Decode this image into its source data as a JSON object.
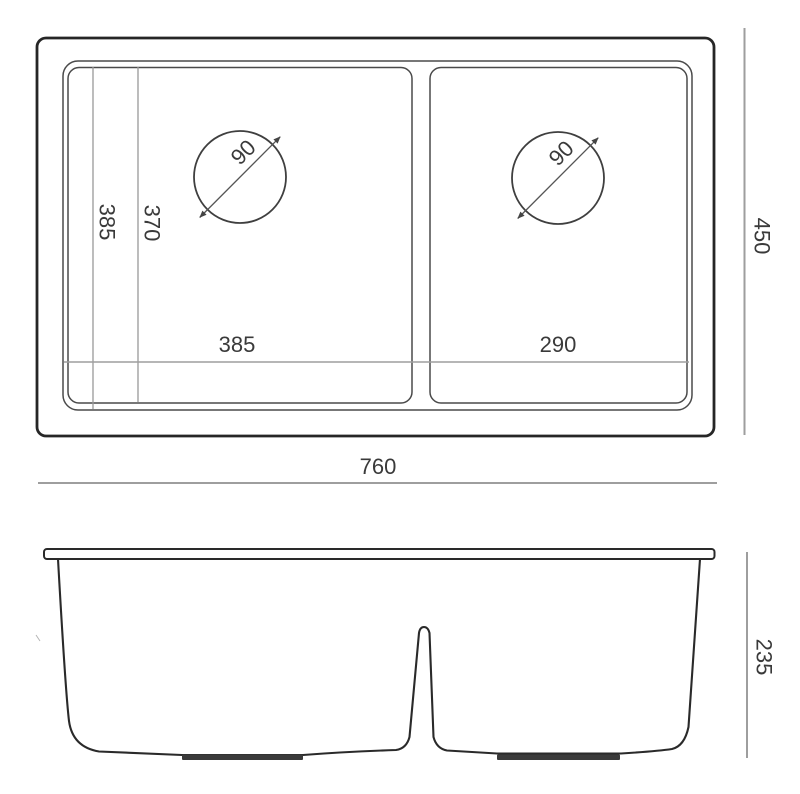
{
  "drawing": {
    "kind": "double-bowl-sink-technical-drawing",
    "colors": {
      "outline": "#262626",
      "bowl_line": "#4a4a4a",
      "dimension_line": "#9e9e9e",
      "text": "#3a3a3a",
      "background": "#ffffff"
    },
    "top_view": {
      "overall_width": "760",
      "overall_depth": "450",
      "left_bowl_width": "385",
      "right_bowl_width": "290",
      "left_inner_dim_a": "385",
      "left_inner_dim_b": "370",
      "left_drain_diameter": "90",
      "right_drain_diameter": "90"
    },
    "front_view": {
      "bowl_height": "235"
    }
  }
}
